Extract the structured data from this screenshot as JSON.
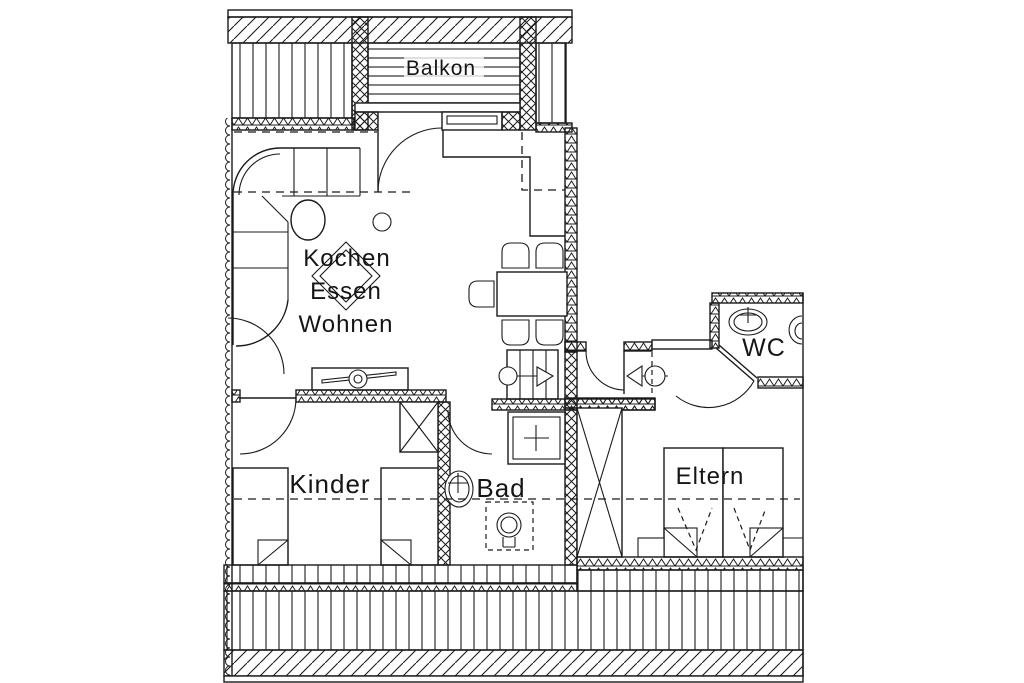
{
  "plan": {
    "kind": "apartment-floor-plan",
    "rooms": {
      "balkon": {
        "label": "Balkon"
      },
      "living": {
        "lines": [
          "Kochen",
          "Essen",
          "Wohnen"
        ]
      },
      "wc": {
        "label": "WC"
      },
      "kinder": {
        "label": "Kinder"
      },
      "bad": {
        "label": "Bad"
      },
      "eltern": {
        "label": "Eltern"
      }
    },
    "colors": {
      "ink": "#1a1a1a",
      "paper": "#ffffff"
    }
  }
}
